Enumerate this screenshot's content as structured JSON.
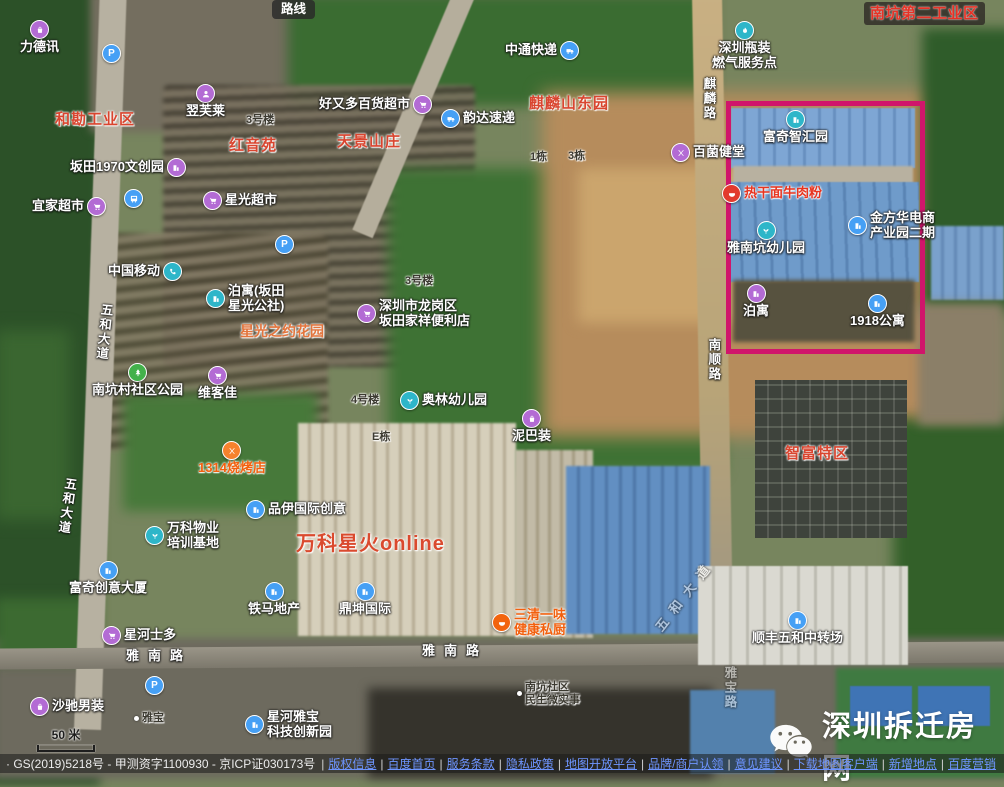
{
  "map": {
    "scale_label": "50 米",
    "highlight_color": "#d0156b",
    "markers": [
      {
        "name": "route-chip",
        "kind": "chip-dark",
        "text": "路线",
        "x": 272,
        "y": 0,
        "clickable": true
      },
      {
        "name": "poi-lidexun",
        "kind": "poi",
        "icon": "bag",
        "color": "#b36bd4",
        "iconPos": "above",
        "text": "力德讯",
        "x": 20,
        "y": 20,
        "clickable": true
      },
      {
        "name": "parking-icon-1",
        "kind": "icon-only",
        "icon": "parking",
        "color": "#46a0f5",
        "x": 102,
        "y": 44,
        "clickable": true
      },
      {
        "name": "poi-zhongtong-express",
        "kind": "poi",
        "icon": "truck",
        "color": "#46a0f5",
        "iconPos": "right",
        "text": "中通快递",
        "x": 505,
        "y": 41,
        "clickable": true
      },
      {
        "name": "poi-gas-service",
        "kind": "poi",
        "icon": "flame",
        "color": "#2eb6c9",
        "iconPos": "above",
        "lines": [
          "深圳瓶装",
          "燃气服务点"
        ],
        "x": 712,
        "y": 21,
        "clickable": true
      },
      {
        "name": "label-nankeng-second-industrial",
        "kind": "chip-dark-red",
        "text": "南坑第二工业区",
        "x": 864,
        "y": 2,
        "clickable": false
      },
      {
        "name": "area-hekan-industrial",
        "kind": "area",
        "text": "和勘工业区",
        "x": 55,
        "y": 111,
        "clickable": false
      },
      {
        "name": "poi-yifulai",
        "kind": "poi",
        "icon": "person",
        "color": "#b36bd4",
        "iconPos": "above",
        "text": "翌芙莱",
        "x": 186,
        "y": 84,
        "clickable": true
      },
      {
        "name": "poi-haoyouduo",
        "kind": "poi",
        "icon": "cart",
        "color": "#b36bd4",
        "iconPos": "right",
        "text": "好又多百货超市",
        "x": 319,
        "y": 95,
        "clickable": true
      },
      {
        "name": "label-bldg-3hao-a",
        "kind": "small",
        "text": "3号楼",
        "x": 246,
        "y": 114,
        "clickable": false
      },
      {
        "name": "area-hongyinyuan",
        "kind": "area",
        "text": "红音苑",
        "x": 229,
        "y": 137,
        "clickable": false
      },
      {
        "name": "area-tianjing",
        "kind": "area",
        "text": "天景山庄",
        "x": 337,
        "y": 133,
        "clickable": false
      },
      {
        "name": "area-qilin-east",
        "kind": "area",
        "text": "麒麟山东园",
        "x": 529,
        "y": 95,
        "clickable": false
      },
      {
        "name": "poi-yunda-express",
        "kind": "poi",
        "icon": "truck",
        "color": "#46a0f5",
        "iconPos": "left",
        "text": "韵达速递",
        "x": 441,
        "y": 109,
        "clickable": true
      },
      {
        "name": "road-qilin",
        "kind": "road-v",
        "text": "麒麟路",
        "x": 701,
        "y": 77,
        "clickable": false
      },
      {
        "name": "poi-fuqi-zhihui",
        "kind": "poi",
        "icon": "building",
        "color": "#2eb6c9",
        "iconPos": "above",
        "text": "富奇智汇园",
        "x": 763,
        "y": 110,
        "clickable": true
      },
      {
        "name": "poi-bantian-1970",
        "kind": "poi",
        "icon": "building",
        "color": "#b36bd4",
        "iconPos": "right",
        "text": "坂田1970文创园",
        "x": 70,
        "y": 158,
        "clickable": true
      },
      {
        "name": "poi-baijun",
        "kind": "poi",
        "icon": "food",
        "color": "#b36bd4",
        "iconPos": "left",
        "text": "百菌健堂",
        "x": 671,
        "y": 143,
        "clickable": true
      },
      {
        "name": "poi-reganmian",
        "kind": "poi-red",
        "icon": "bowl",
        "color": "#e23a2d",
        "iconPos": "left",
        "text": "热干面牛肉粉",
        "x": 722,
        "y": 184,
        "clickable": true
      },
      {
        "name": "poi-yijia",
        "kind": "poi",
        "icon": "cart",
        "color": "#b36bd4",
        "iconPos": "right",
        "text": "宜家超市",
        "x": 32,
        "y": 197,
        "clickable": true
      },
      {
        "name": "metro-icon",
        "kind": "icon-only",
        "icon": "bus",
        "color": "#46a0f5",
        "x": 124,
        "y": 189,
        "clickable": true
      },
      {
        "name": "poi-xingguang-market",
        "kind": "poi",
        "icon": "cart",
        "color": "#b36bd4",
        "iconPos": "left",
        "text": "星光超市",
        "x": 203,
        "y": 191,
        "clickable": true
      },
      {
        "name": "poi-jinfanghua",
        "kind": "poi",
        "icon": "building",
        "color": "#46a0f5",
        "iconPos": "left",
        "lines": [
          "金方华电商",
          "产业园二期"
        ],
        "x": 848,
        "y": 211,
        "clickable": true
      },
      {
        "name": "poi-yanankeng-kindergarten",
        "kind": "poi",
        "icon": "plant",
        "color": "#2eb6c9",
        "iconPos": "above",
        "text": "雅南坑幼儿园",
        "x": 727,
        "y": 221,
        "clickable": true
      },
      {
        "name": "poi-china-mobile",
        "kind": "poi",
        "icon": "phone",
        "color": "#2eb6c9",
        "iconPos": "right",
        "text": "中国移动",
        "x": 108,
        "y": 262,
        "clickable": true
      },
      {
        "name": "parking-icon-2",
        "kind": "icon-only",
        "icon": "parking",
        "color": "#46a0f5",
        "x": 275,
        "y": 235,
        "clickable": true
      },
      {
        "name": "poi-boyu-xingguang",
        "kind": "poi",
        "icon": "building",
        "color": "#2eb6c9",
        "iconPos": "left",
        "lines": [
          "泊寓(坂田",
          "星光公社)"
        ],
        "x": 206,
        "y": 284,
        "clickable": true
      },
      {
        "name": "poi-boyu",
        "kind": "poi",
        "icon": "building",
        "color": "#b36bd4",
        "iconPos": "above",
        "text": "泊寓",
        "x": 743,
        "y": 284,
        "clickable": true
      },
      {
        "name": "poi-1918-apartment",
        "kind": "poi",
        "icon": "building",
        "color": "#46a0f5",
        "iconPos": "above",
        "text": "1918公寓",
        "x": 850,
        "y": 294,
        "clickable": true
      },
      {
        "name": "poi-jiaxiang-store",
        "kind": "poi",
        "icon": "cart",
        "color": "#b36bd4",
        "iconPos": "left",
        "lines": [
          "深圳市龙岗区",
          "坂田家祥便利店"
        ],
        "x": 357,
        "y": 299,
        "clickable": true
      },
      {
        "name": "road-wuhe-avenue-1",
        "kind": "road-v",
        "text": "五和大道",
        "x": 96,
        "y": 303,
        "rotate": 6,
        "clickable": false
      },
      {
        "name": "area-xingguang-zhiyue",
        "kind": "area-orange",
        "text": "星光之约花园",
        "x": 240,
        "y": 323,
        "clickable": false
      },
      {
        "name": "label-bldg-3hao-b",
        "kind": "small",
        "text": "3号楼",
        "x": 405,
        "y": 275,
        "clickable": false
      },
      {
        "name": "road-nanshun",
        "kind": "road-v",
        "text": "南顺路",
        "x": 706,
        "y": 338,
        "clickable": false
      },
      {
        "name": "poi-nankeng-park",
        "kind": "poi",
        "icon": "tree",
        "color": "#43b14b",
        "iconPos": "above",
        "text": "南坑村社区公园",
        "x": 92,
        "y": 363,
        "clickable": true
      },
      {
        "name": "poi-weikejia",
        "kind": "poi",
        "icon": "cart",
        "color": "#b36bd4",
        "iconPos": "above",
        "text": "维客佳",
        "x": 198,
        "y": 366,
        "clickable": true
      },
      {
        "name": "label-bldg-4hao",
        "kind": "small",
        "text": "4号楼",
        "x": 351,
        "y": 394,
        "clickable": false
      },
      {
        "name": "poi-aolin-kindergarten",
        "kind": "poi",
        "icon": "plant",
        "color": "#2eb6c9",
        "iconPos": "left",
        "text": "奥林幼儿园",
        "x": 400,
        "y": 391,
        "clickable": true
      },
      {
        "name": "poi-nibazhuang",
        "kind": "poi",
        "icon": "bag",
        "color": "#b36bd4",
        "iconPos": "above",
        "text": "泥巴装",
        "x": 512,
        "y": 409,
        "clickable": true
      },
      {
        "name": "label-bldg-e",
        "kind": "small",
        "text": "E栋",
        "x": 372,
        "y": 431,
        "clickable": false
      },
      {
        "name": "label-bldg-1dong",
        "kind": "small",
        "text": "1栋",
        "x": 530,
        "y": 151,
        "clickable": false
      },
      {
        "name": "label-bldg-3dong",
        "kind": "small",
        "text": "3栋",
        "x": 568,
        "y": 150,
        "clickable": false
      },
      {
        "name": "poi-1314-bbq",
        "kind": "poi-orange",
        "icon": "food",
        "color": "#f6822d",
        "iconPos": "above",
        "text": "1314烧烤店",
        "x": 198,
        "y": 441,
        "clickable": true
      },
      {
        "name": "area-zhifu",
        "kind": "area",
        "text": "智富特区",
        "x": 785,
        "y": 445,
        "clickable": false
      },
      {
        "name": "road-wuhe-avenue-2",
        "kind": "road-v",
        "text": "五和大道",
        "x": 59,
        "y": 477,
        "rotate": 8,
        "clickable": false
      },
      {
        "name": "poi-pinyi",
        "kind": "poi",
        "icon": "building",
        "color": "#46a0f5",
        "iconPos": "left",
        "text": "品伊国际创意",
        "x": 246,
        "y": 500,
        "clickable": true
      },
      {
        "name": "poi-vanke-property",
        "kind": "poi",
        "icon": "plant",
        "color": "#2eb6c9",
        "iconPos": "left",
        "lines": [
          "万科物业",
          "培训基地"
        ],
        "x": 145,
        "y": 521,
        "clickable": true
      },
      {
        "name": "area-vanke-online",
        "kind": "area-big",
        "text": "万科星火online",
        "x": 296,
        "y": 533,
        "clickable": false
      },
      {
        "name": "poi-fuqi-tower",
        "kind": "poi",
        "icon": "building",
        "color": "#46a0f5",
        "iconPos": "above",
        "text": "富奇创意大厦",
        "x": 69,
        "y": 561,
        "clickable": true
      },
      {
        "name": "poi-tiema",
        "kind": "poi",
        "icon": "building",
        "color": "#46a0f5",
        "iconPos": "above",
        "text": "铁马地产",
        "x": 248,
        "y": 582,
        "clickable": true
      },
      {
        "name": "poi-dingkun",
        "kind": "poi",
        "icon": "building",
        "color": "#46a0f5",
        "iconPos": "above",
        "text": "鼎坤国际",
        "x": 339,
        "y": 582,
        "clickable": true
      },
      {
        "name": "ghost-road-wuhe",
        "kind": "road-h",
        "text": "五和大道",
        "x": 642,
        "y": 588,
        "rotate": -52,
        "opacity": 0.5,
        "clickable": false
      },
      {
        "name": "poi-sanqing",
        "kind": "poi-orange",
        "icon": "bowl",
        "color": "#f2640e",
        "iconPos": "left",
        "lines": [
          "三清一味",
          "健康私厨"
        ],
        "x": 492,
        "y": 608,
        "clickable": true
      },
      {
        "name": "poi-sf-transfer",
        "kind": "poi",
        "icon": "building",
        "color": "#46a0f5",
        "iconPos": "above",
        "text": "顺丰五和中转场",
        "x": 752,
        "y": 611,
        "clickable": true
      },
      {
        "name": "poi-xinghe-store",
        "kind": "poi",
        "icon": "cart",
        "color": "#b36bd4",
        "iconPos": "left",
        "text": "星河士多",
        "x": 102,
        "y": 626,
        "clickable": true
      },
      {
        "name": "road-yanan-1",
        "kind": "road-h",
        "text": "雅南路",
        "x": 126,
        "y": 649,
        "clickable": false
      },
      {
        "name": "road-yanan-2",
        "kind": "road-h",
        "text": "雅南路",
        "x": 422,
        "y": 644,
        "clickable": false
      },
      {
        "name": "parking-icon-3",
        "kind": "icon-only",
        "icon": "parking",
        "color": "#46a0f5",
        "x": 145,
        "y": 676,
        "clickable": true
      },
      {
        "name": "ghost-road-yabao",
        "kind": "road-v",
        "text": "雅宝路",
        "x": 722,
        "y": 666,
        "opacity": 0.5,
        "clickable": false
      },
      {
        "name": "poi-shachi",
        "kind": "poi",
        "icon": "bag",
        "color": "#b36bd4",
        "iconPos": "left",
        "text": "沙驰男装",
        "x": 30,
        "y": 697,
        "clickable": true
      },
      {
        "name": "label-yabao",
        "kind": "small-dot",
        "text": "雅宝",
        "x": 134,
        "y": 712,
        "clickable": false
      },
      {
        "name": "poi-xinghe-yabao",
        "kind": "poi",
        "icon": "building",
        "color": "#46a0f5",
        "iconPos": "left",
        "lines": [
          "星河雅宝",
          "科技创新园"
        ],
        "x": 245,
        "y": 710,
        "clickable": true
      },
      {
        "name": "label-nankeng-shequ",
        "kind": "small-dot",
        "lines": [
          "南坑社区",
          "民生微实事"
        ],
        "x": 517,
        "y": 681,
        "clickable": false
      }
    ]
  },
  "watermark": {
    "text": "深圳拆迁房网"
  },
  "footer": {
    "meta": "· GS(2019)5218号 - 甲测资字1100930 - 京ICP证030173号",
    "links": [
      "版权信息",
      "百度首页",
      "服务条款",
      "隐私政策",
      "地图开放平台",
      "品牌/商户认领",
      "意见建议",
      "下载地图客户端",
      "新增地点",
      "百度营销"
    ]
  }
}
